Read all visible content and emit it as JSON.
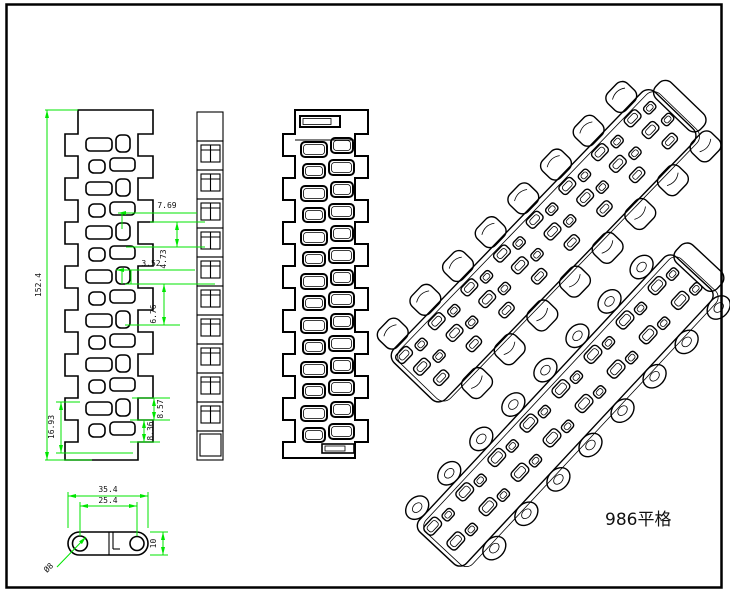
{
  "drawing": {
    "title": "986平格",
    "background": "#ffffff",
    "line_color": "#000000",
    "dimension_color": "#00e600",
    "dimensions": {
      "overall_length": "152.4",
      "end_pitch": "16.93",
      "slot_spacing": "7.69",
      "slot_gap": "4.73",
      "slot_offset": "3.52",
      "slot_length": "6.76",
      "edge_dim_a": "8.57",
      "edge_dim_b": "8.36",
      "plate_length": "35.4",
      "hole_pitch": "25.4",
      "plate_width": "10",
      "hole_diameter": "Ø8"
    }
  }
}
